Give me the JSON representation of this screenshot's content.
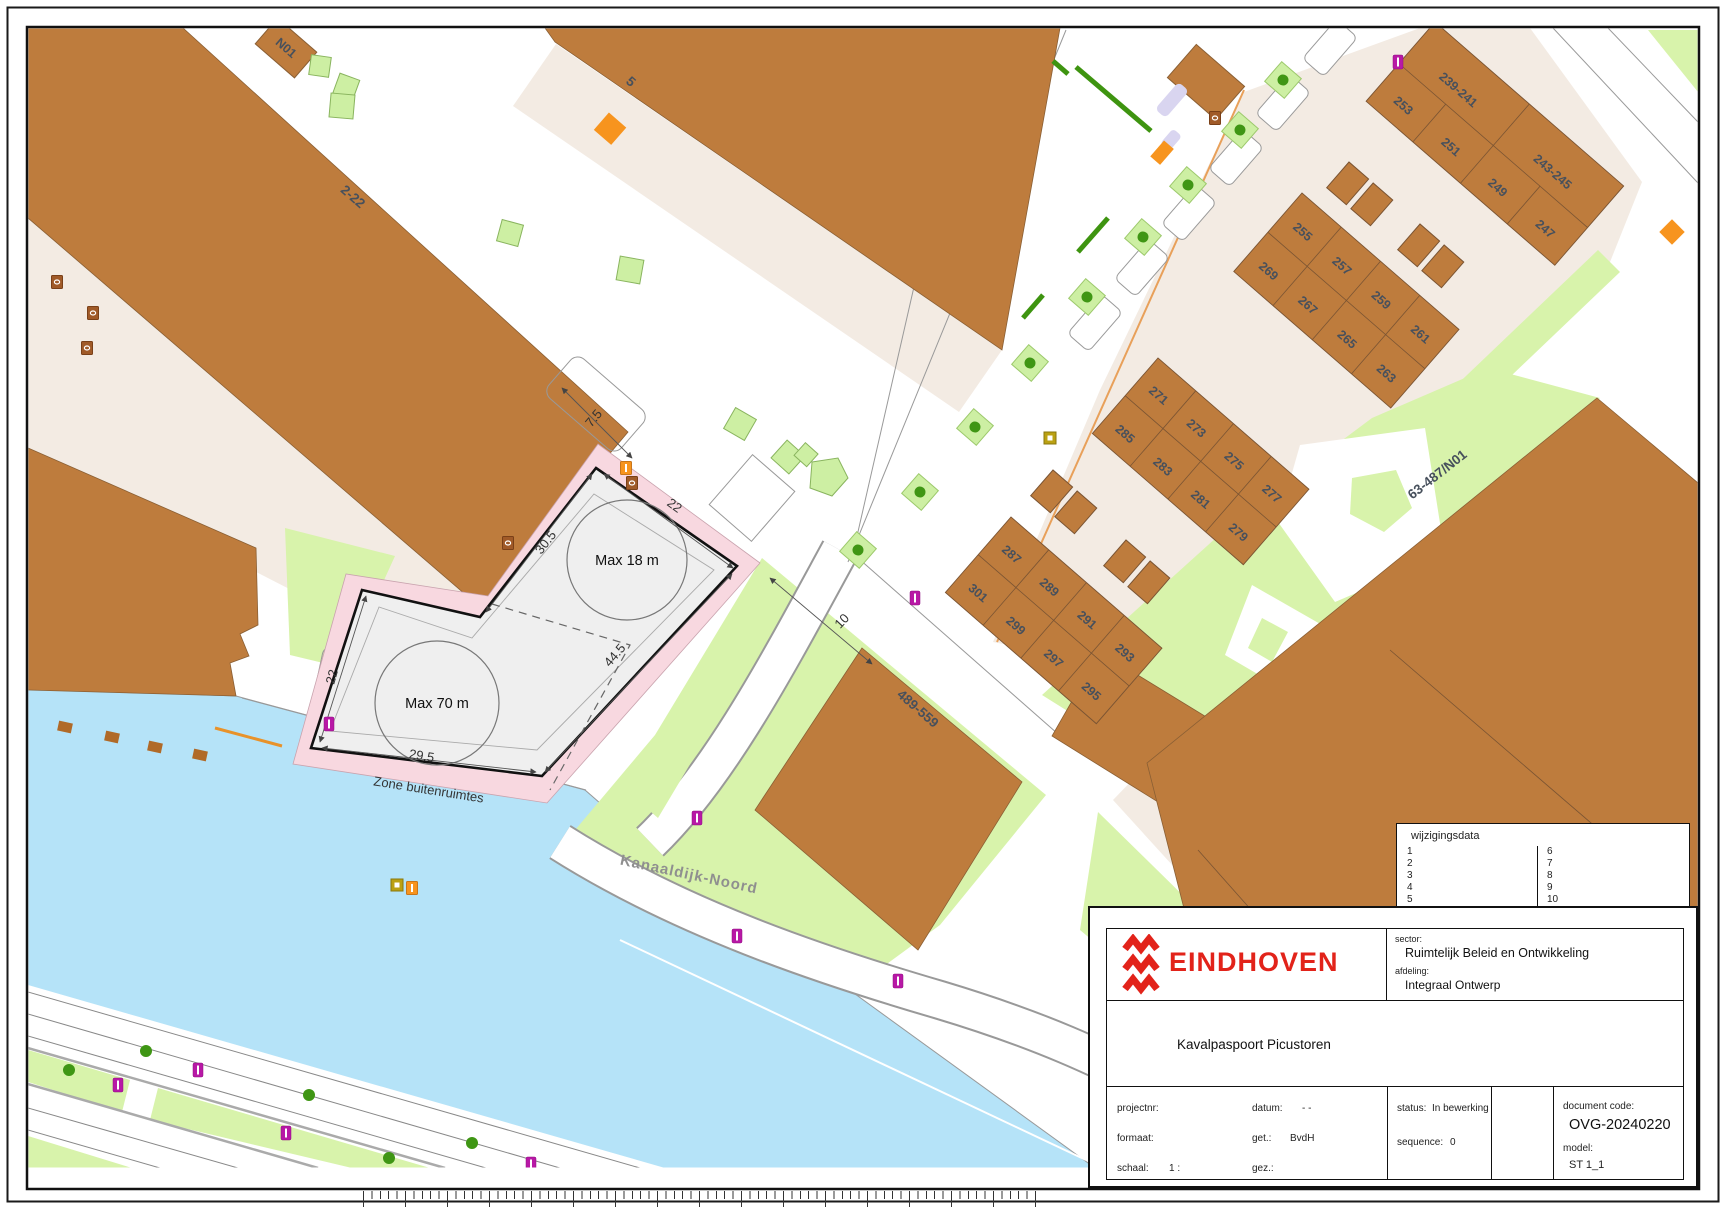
{
  "palette": {
    "building_brown": "#BE7C3D",
    "yard_beige": "#F3EBE3",
    "green": "#D8F3AB",
    "tree_square": "#CDEFA3",
    "tree_dot": "#3F9614",
    "water_blue": "#B5E3F8",
    "zone_pink": "#F8D8E0",
    "parcel_gray": "#EFEFEF",
    "marker_magenta": "#B818A6",
    "marker_orange": "#F7941E",
    "brand_red": "#E2231A"
  },
  "map": {
    "street_label": "Kanaaldijk-Noord",
    "building_labels": {
      "b5": "5",
      "b2_22": "2-22",
      "n01": "N01",
      "b489": "489-559",
      "b63": "63-487/N01"
    },
    "lots": [
      "239-241",
      "243-245",
      "253",
      "251",
      "249",
      "247",
      "255",
      "257",
      "259",
      "261",
      "269",
      "267",
      "265",
      "263",
      "271",
      "273",
      "275",
      "277",
      "285",
      "283",
      "281",
      "279",
      "287",
      "289",
      "291",
      "293",
      "301",
      "299",
      "297",
      "295"
    ],
    "parcel": {
      "max18": "Max 18 m",
      "max70": "Max 70 m",
      "zone_label": "Zone buitenruimtes",
      "dims": {
        "gap": "7.5",
        "side_nw": "30.5",
        "top": "22",
        "left": "22",
        "side_se": "44.5",
        "bottom": "29.5",
        "road": "10"
      }
    }
  },
  "wijzigingsdata": {
    "title": "wijzigingsdata",
    "left": [
      "1",
      "2",
      "3",
      "4",
      "5"
    ],
    "right": [
      "6",
      "7",
      "8",
      "9",
      "10"
    ]
  },
  "title_block": {
    "logo_text": "EINDHOVEN",
    "sector_label": "sector:",
    "sector": "Ruimtelijk Beleid en Ontwikkeling",
    "afdeling_label": "afdeling:",
    "afdeling": "Integraal Ontwerp",
    "title": "Kavalpaspoort Picustoren",
    "projectnr_label": "projectnr:",
    "formaat_label": "formaat:",
    "schaal_label": "schaal:",
    "schaal_value": "1 :",
    "datum_label": "datum:",
    "datum_value": "- -",
    "get_label": "get.:",
    "get_value": "BvdH",
    "gez_label": "gez.:",
    "status_label": "status:",
    "status_value": "In bewerking",
    "sequence_label": "sequence:",
    "sequence_value": "0",
    "doccode_label": "document code:",
    "doccode": "OVG-20240220",
    "model_label": "model:",
    "model": "ST 1_1"
  }
}
